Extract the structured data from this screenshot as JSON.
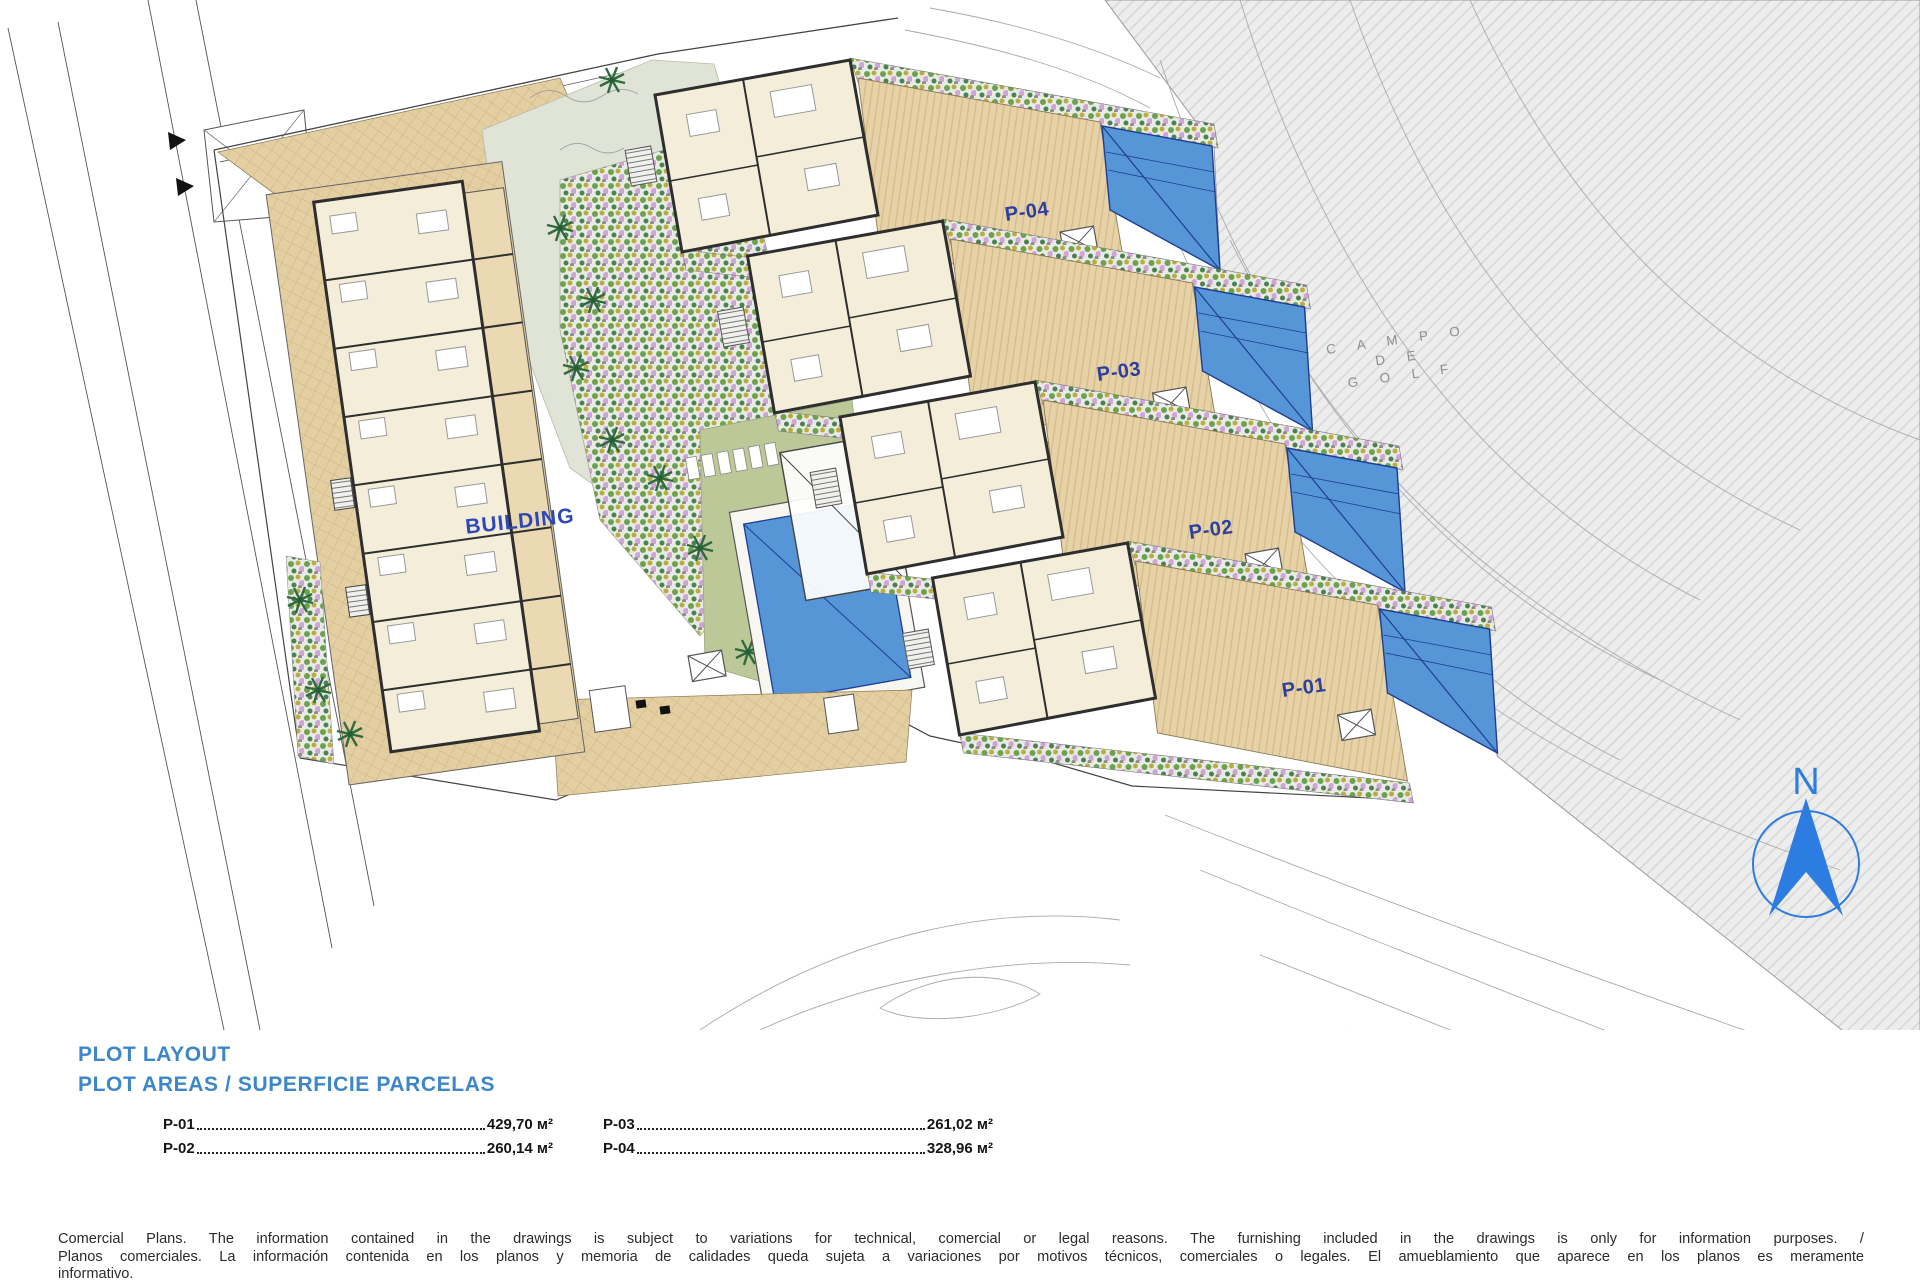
{
  "plan": {
    "building_label": "BUILDING",
    "plot_labels": {
      "p01": "P-01",
      "p02": "P-02",
      "p03": "P-03",
      "p04": "P-04"
    },
    "golf_label_lines": [
      "C A M P O",
      "D E",
      "G O L F"
    ],
    "compass_letter": "N"
  },
  "legend": {
    "title_line1": "PLOT LAYOUT",
    "title_line2": "PLOT AREAS / SUPERFICIE PARCELAS",
    "areas": [
      {
        "label": "P-01",
        "value": "429,70 м²"
      },
      {
        "label": "P-02",
        "value": "260,14 м²"
      },
      {
        "label": "P-03",
        "value": "261,02 м²"
      },
      {
        "label": "P-04",
        "value": "328,96 м²"
      }
    ]
  },
  "disclaimer": {
    "line1": "Comercial Plans. The information contained in the drawings is subject to variations for technical, comercial or legal reasons. The furnishing included in the drawings is only for information purposes. /",
    "line2": "Planos comerciales. La información contenida en los planos y memoria de calidades queda sujeta a variaciones por motivos técnicos, comerciales o legales. El amueblamiento que aparece en los planos es meramente",
    "line3": "informativo."
  },
  "colors": {
    "heading_blue": "#3d87c8",
    "label_blue": "#2c3f9f",
    "building_blue": "#2d49b8",
    "pool_blue": "#5695d6",
    "pool_line": "#1d3e94",
    "terrace_beige": "#e3cfa1",
    "plan_cream": "#f3edda",
    "lawn_green": "#bcc898",
    "golf_gray": "#ededed",
    "compass_blue": "#2d7ce2"
  }
}
